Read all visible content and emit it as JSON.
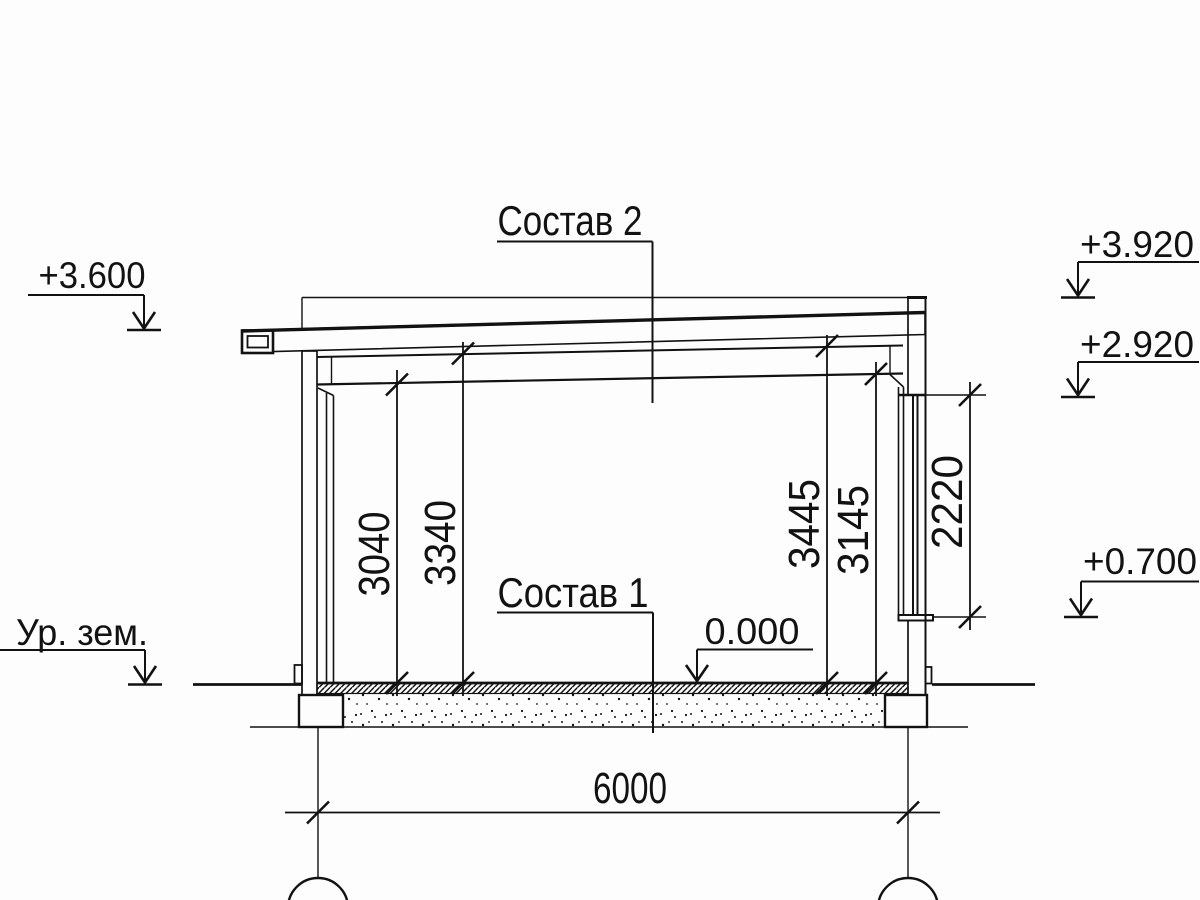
{
  "drawing": {
    "title": "building section drawing",
    "ink_color": "#121212",
    "background_color": "#fdfdfd"
  },
  "labels": {
    "roof_composition": "Состав 2",
    "floor_composition": "Состав 1"
  },
  "elevations": {
    "ground_level": "Ур. зем.",
    "eave_level": "+3.600",
    "parapet_level": "+3.920",
    "opening_top_level": "+2.920",
    "sill_level": "+0.700",
    "floor_level": "0.000"
  },
  "dimensions": {
    "clear_height_left": "3040",
    "soffit_height_left": "3340",
    "soffit_height_right": "3445",
    "clear_height_right": "3145",
    "opening_height": "2220",
    "span": "6000"
  }
}
